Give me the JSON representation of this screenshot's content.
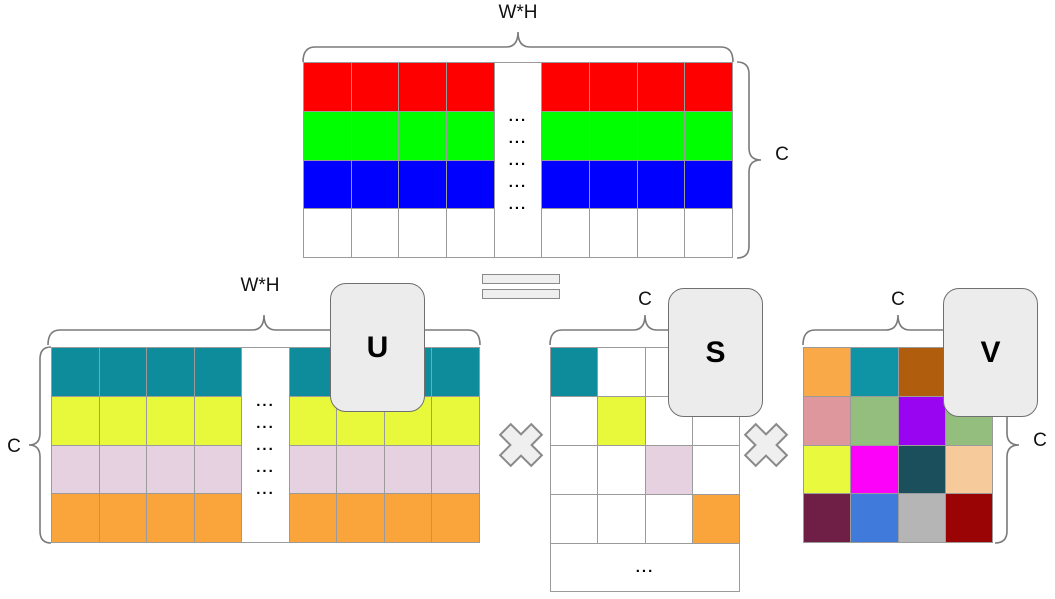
{
  "labels": {
    "original_width": "W*H",
    "original_height": "C",
    "u_width": "W*H",
    "u_height": "C",
    "s_width": "C",
    "v_width": "C",
    "v_height": "C"
  },
  "cards": {
    "u": "U",
    "s": "S",
    "v": "V"
  },
  "ellipsis": "...",
  "ellipsis_repeat": 5,
  "colors": {
    "grid_line": "#9B9B9B",
    "card_fill": "#ECECEC",
    "card_border": "#707070",
    "operator_fill": "#EFEFEF",
    "operator_border": "#8A8A8A",
    "brace": "#7A7A7A",
    "text": "#111111"
  },
  "matrices": {
    "original": {
      "columns": 9,
      "dots_column": 4,
      "row_colors": [
        "#FF0000",
        "#00FF00",
        "#0000FF",
        "#FFFFFF"
      ]
    },
    "u": {
      "columns": 9,
      "dots_column": 4,
      "row_colors": [
        "#0E8C9C",
        "#E8F93C",
        "#E5D1DF",
        "#FAA43C"
      ]
    },
    "s": {
      "size": 4,
      "diagonal_colors": [
        "#0E8C9C",
        "#E8F93C",
        "#E5D1DF",
        "#FAA43C"
      ],
      "off_diagonal_color": "#FFFFFF"
    },
    "v": {
      "rows": [
        [
          "#F9A947",
          "#0E94A4",
          "#B05E0D",
          "#FFFFFF"
        ],
        [
          "#DE989D",
          "#93BE7E",
          "#9905F0",
          "#93BE7E"
        ],
        [
          "#E9FA3E",
          "#FD02F8",
          "#1A4F5B",
          "#F7CA9C"
        ],
        [
          "#6F1E45",
          "#407BDB",
          "#B5B5B5",
          "#9B0404"
        ]
      ]
    }
  }
}
